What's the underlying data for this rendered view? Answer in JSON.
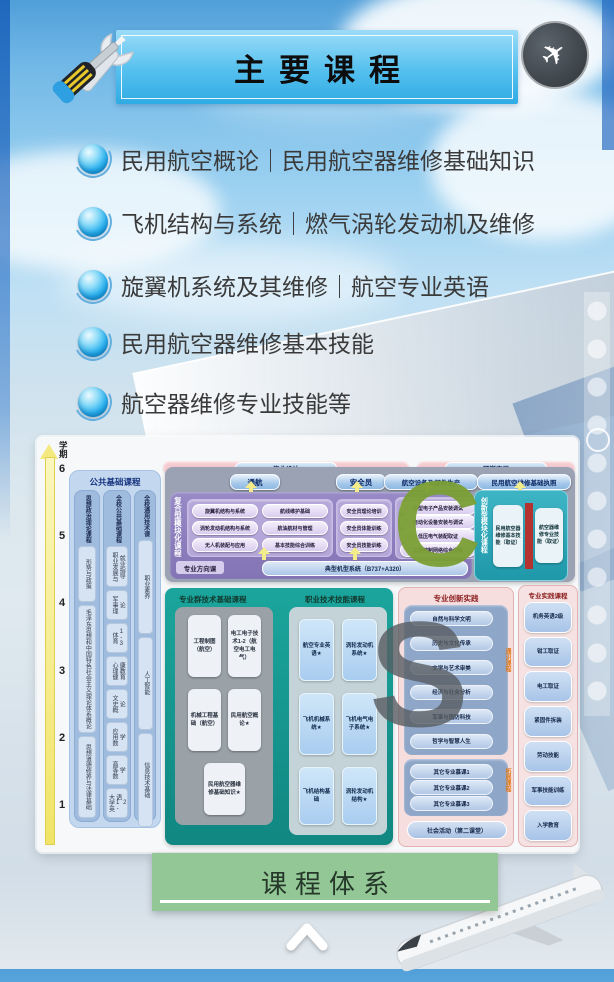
{
  "header": {
    "title": "主要课程"
  },
  "courses": [
    "民用航空概论｜民用航空器维修基础知识",
    "飞机结构与系统｜燃气涡轮发动机及维修",
    "旋翼机系统及其维修｜航空专业英语",
    "民用航空器维修基本技能",
    "航空器维修专业技能等"
  ],
  "diagram": {
    "axis": {
      "label": "学期",
      "ticks": [
        "6",
        "5",
        "4",
        "3",
        "2",
        "1"
      ]
    },
    "public_basic": {
      "title": "公共基础课程",
      "columns": [
        {
          "title": "思想政治理论课程",
          "items": [
            "形势与政策",
            "毛泽东思想和中国特色社会主义理论体系概论",
            "思想道德修养与法律基础"
          ]
        },
        {
          "title": "全校公共基础课程",
          "items": [
            "职业发展与就业指导",
            "军事理论",
            "体育1-3",
            "心理健康教育",
            "文史概论",
            "应用数学",
            "高等数学",
            "大学英语1-2"
          ]
        },
        {
          "title": "全校通用技术课",
          "items": [
            "职业素养",
            "人工智能",
            "信息技术基础"
          ]
        }
      ]
    },
    "banners": [
      "毕业设计",
      "顶岗实习"
    ],
    "track_buttons": [
      "通航",
      "安全员",
      "航空设备及部件生产",
      "民用航空维修基础执照"
    ],
    "composite": {
      "title": "复合型模块化课程",
      "groups": [
        [
          "旋翼机结构与系统",
          "涡轮发动机结构与系统",
          "无人机装配与应用"
        ],
        [
          "航线维护基础",
          "航油航材与管理",
          "基本技能综合训练"
        ],
        [
          "安全员理论培训",
          "安全员体能训练",
          "安全员技能训练"
        ],
        [
          "小型电子产品安装调试",
          "自动化设备安装与调试",
          "低压电气装配取证",
          "工业控制网络综合训练"
        ]
      ],
      "direction_label": "专业方向课",
      "direction_course": "典型机型系统（B737+A320）"
    },
    "innovation_module": {
      "title": "创新型模块化课程",
      "items": [
        "民用航空器维修基本技能（取证）",
        "航空器维修专业技能（取证）"
      ]
    },
    "tech_basic": {
      "title": "专业群技术基础课程",
      "items": [
        "工程制图（航空）",
        "电工电子技术1-2（航空电工电气）",
        "机械工程基础（航空）",
        "民用航空概论★",
        "民用航空器维修基础知识★"
      ]
    },
    "vocational": {
      "title": "职业技术技能课程",
      "items": [
        "航空专业英语★",
        "涡轮发动机系统★",
        "飞机机械系统★",
        "飞机电气电子系统★",
        "飞机结构基础",
        "涡轮发动机结构★"
      ]
    },
    "practice_innovation": {
      "title": "专业创新实践",
      "general_label": "通识课程",
      "general_items": [
        "自然与科学文明",
        "历史与文化传承",
        "文学与艺术审美",
        "经济与社会分析",
        "军事与国防科技",
        "哲学与智慧人生"
      ],
      "expansion_label": "拓展课程",
      "expansion_items": [
        "其它专业慕课1",
        "其它专业慕课2",
        "其它专业慕课3"
      ],
      "footer": "社会活动（第二课堂）"
    },
    "practice_courses": {
      "title": "专业实践课程",
      "items": [
        "机务英语2级",
        "钳工取证",
        "电工取证",
        "紧固件拆装",
        "劳动技能",
        "军事技能训练",
        "入学教育"
      ]
    },
    "watermarks": [
      "C",
      "S"
    ]
  },
  "footer": {
    "button_label": "课程体系"
  },
  "icons": {
    "badge_plane": "✈"
  },
  "colors": {
    "accent_teal": "#18a39a",
    "accent_purple": "#8a7bbd",
    "accent_green": "#93c795",
    "banner_blue": "#3fb1e6"
  }
}
